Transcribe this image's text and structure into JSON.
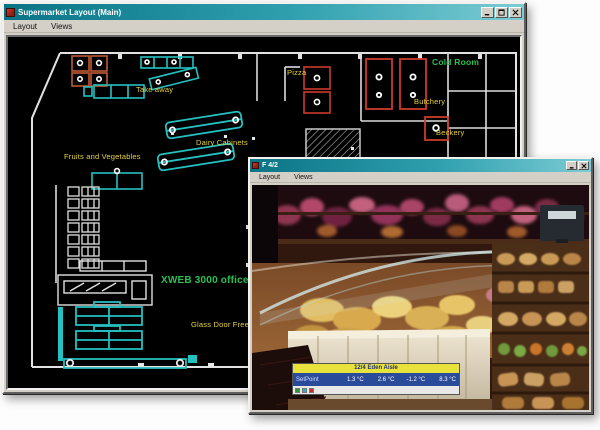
{
  "colors": {
    "titlebar_gradient_left": "#0a7486",
    "titlebar_gradient_right": "#7bccd4",
    "window_chrome": "#d4d0c8",
    "canvas_background": "#000000",
    "label_yellow": "#e6d23c",
    "label_green": "#28c052",
    "cabinet_teal": "#25c0c0",
    "coldroom_red": "#cc3b2a",
    "coldroom_orange": "#bf5a36",
    "overlay_header_bg": "#e8e23c",
    "overlay_body_bg": "#2a4a9a"
  },
  "main_window": {
    "title": "Supermarket Layout (Main)",
    "menu": [
      {
        "label": "Layout"
      },
      {
        "label": "Views"
      }
    ],
    "controls": [
      {
        "name": "minimize"
      },
      {
        "name": "maximize"
      },
      {
        "name": "close"
      }
    ]
  },
  "plan": {
    "labels": [
      {
        "text": "Take away",
        "color": "yellow"
      },
      {
        "text": "Pizza",
        "color": "yellow"
      },
      {
        "text": "Cold Room",
        "color": "green"
      },
      {
        "text": "Butchery",
        "color": "yellow"
      },
      {
        "text": "Beckery",
        "color": "yellow"
      },
      {
        "text": "Dairy Cabinets",
        "color": "yellow"
      },
      {
        "text": "Fruits and Vegetables",
        "color": "yellow"
      },
      {
        "text": "XWEB 3000 office",
        "color": "green"
      },
      {
        "text": "Glass Door Freezer",
        "color": "yellow"
      }
    ]
  },
  "camera_window": {
    "title": "F 4/2",
    "menu": [
      {
        "label": "Layout"
      },
      {
        "label": "Views"
      }
    ],
    "controls": [
      {
        "name": "minimize"
      },
      {
        "name": "close"
      }
    ],
    "overlay": {
      "header": "12/4 Eden Aisle",
      "row_label": "SetPoint",
      "values": [
        "1.3 °C",
        "2.6 °C",
        "-1.2 °C",
        "8.3 °C"
      ],
      "status_icons": [
        "status-green",
        "status-cyan",
        "status-red"
      ]
    }
  }
}
